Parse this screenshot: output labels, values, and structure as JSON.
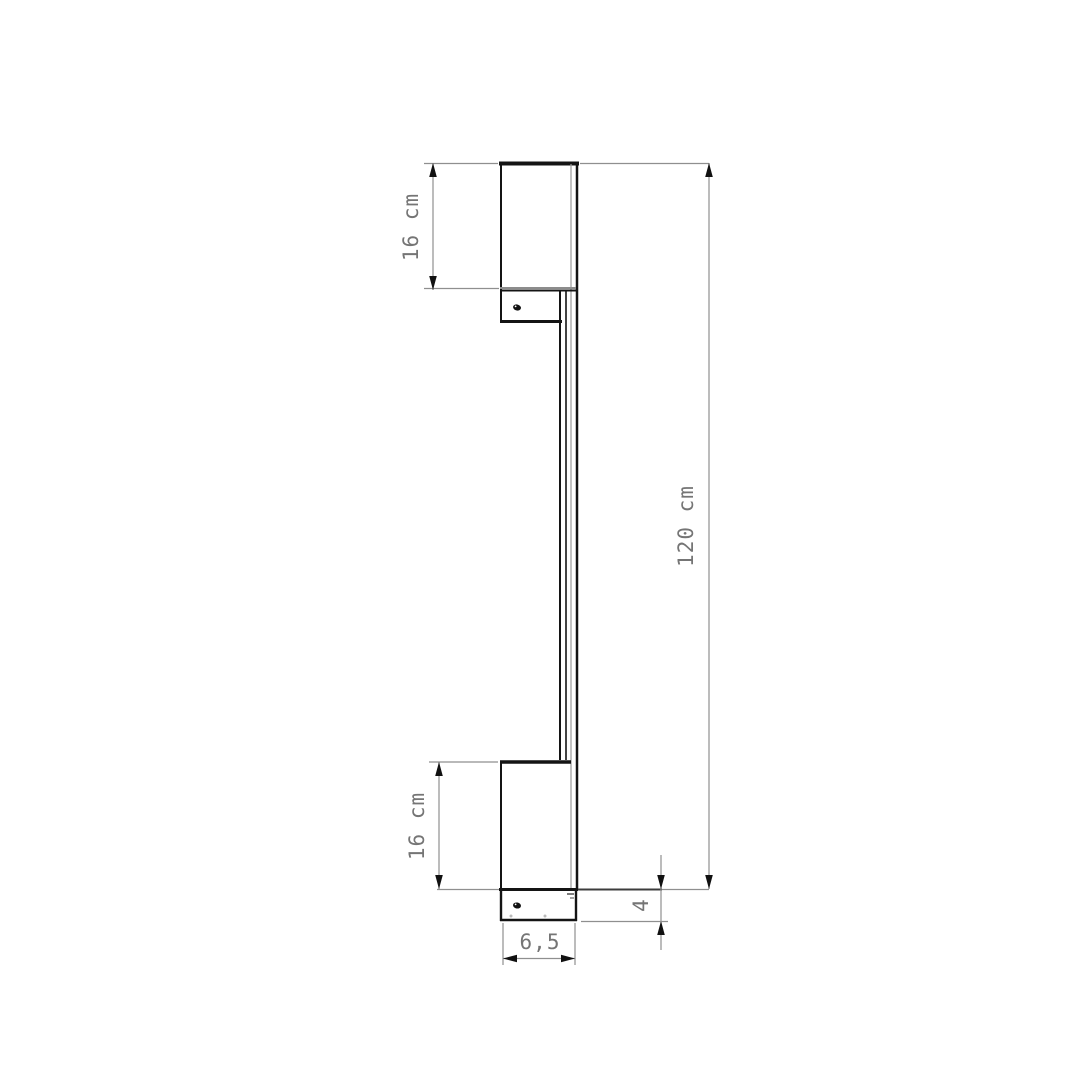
{
  "drawing": {
    "kind": "technical dimension drawing",
    "subject": "linear wall lamp, side profile view with two wall brackets",
    "background_color": "#ffffff",
    "outline_color": "#141414",
    "dimension_line_color": "#8f8f8f",
    "label_color": "#757575",
    "labels": {
      "top_bracket_height": "16 cm",
      "total_height": "120 cm",
      "bottom_bracket_height": "16 cm",
      "base_depth": "4",
      "base_width": "6,5"
    }
  }
}
